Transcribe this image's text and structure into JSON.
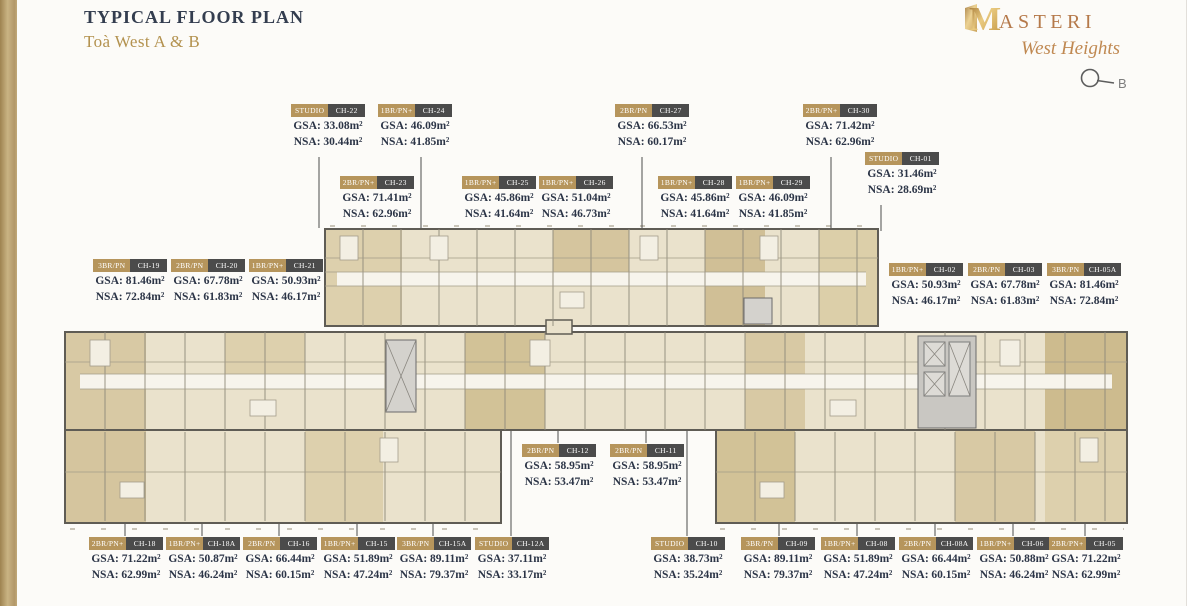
{
  "header": {
    "title": "TYPICAL FLOOR PLAN",
    "subtitle": "Toà West A & B",
    "brand": {
      "name_initial": "M",
      "name_rest": "ASTERI",
      "tagline": "West Heights"
    },
    "compass_label": "B"
  },
  "labels": {
    "gsa": "GSA:",
    "nsa": "NSA:",
    "m2": "m²"
  },
  "colors": {
    "tag_type_bg": "#b6955c",
    "tag_code_bg": "#4b4b4b",
    "title_navy": "#333d4f",
    "subtitle_gold": "#b3924f",
    "brand_copper": "#b5794a",
    "plan_tan": "#eae2cc"
  },
  "units": [
    {
      "type": "STUDIO",
      "code": "CH-22",
      "gsa": "33.08",
      "nsa": "30.44"
    },
    {
      "type": "1BR/PN+",
      "code": "CH-24",
      "gsa": "46.09",
      "nsa": "41.85"
    },
    {
      "type": "2BR/PN",
      "code": "CH-27",
      "gsa": "66.53",
      "nsa": "60.17"
    },
    {
      "type": "2BR/PN+",
      "code": "CH-30",
      "gsa": "71.42",
      "nsa": "62.96"
    },
    {
      "type": "STUDIO",
      "code": "CH-01",
      "gsa": "31.46",
      "nsa": "28.69"
    },
    {
      "type": "2BR/PN+",
      "code": "CH-23",
      "gsa": "71.41",
      "nsa": "62.96"
    },
    {
      "type": "1BR/PN+",
      "code": "CH-25",
      "gsa": "45.86",
      "nsa": "41.64"
    },
    {
      "type": "1BR/PN+",
      "code": "CH-26",
      "gsa": "51.04",
      "nsa": "46.73"
    },
    {
      "type": "1BR/PN+",
      "code": "CH-28",
      "gsa": "45.86",
      "nsa": "41.64"
    },
    {
      "type": "1BR/PN+",
      "code": "CH-29",
      "gsa": "46.09",
      "nsa": "41.85"
    },
    {
      "type": "3BR/PN",
      "code": "CH-19",
      "gsa": "81.46",
      "nsa": "72.84"
    },
    {
      "type": "2BR/PN",
      "code": "CH-20",
      "gsa": "67.78",
      "nsa": "61.83"
    },
    {
      "type": "1BR/PN+",
      "code": "CH-21",
      "gsa": "50.93",
      "nsa": "46.17"
    },
    {
      "type": "1BR/PN+",
      "code": "CH-02",
      "gsa": "50.93",
      "nsa": "46.17"
    },
    {
      "type": "2BR/PN",
      "code": "CH-03",
      "gsa": "67.78",
      "nsa": "61.83"
    },
    {
      "type": "3BR/PN",
      "code": "CH-05A",
      "gsa": "81.46",
      "nsa": "72.84"
    },
    {
      "type": "2BR/PN",
      "code": "CH-12",
      "gsa": "58.95",
      "nsa": "53.47"
    },
    {
      "type": "2BR/PN",
      "code": "CH-11",
      "gsa": "58.95",
      "nsa": "53.47"
    },
    {
      "type": "2BR/PN+",
      "code": "CH-18",
      "gsa": "71.22",
      "nsa": "62.99"
    },
    {
      "type": "1BR/PN+",
      "code": "CH-18A",
      "gsa": "50.87",
      "nsa": "46.24"
    },
    {
      "type": "2BR/PN",
      "code": "CH-16",
      "gsa": "66.44",
      "nsa": "60.15"
    },
    {
      "type": "1BR/PN+",
      "code": "CH-15",
      "gsa": "51.89",
      "nsa": "47.24"
    },
    {
      "type": "3BR/PN",
      "code": "CH-15A",
      "gsa": "89.11",
      "nsa": "79.37"
    },
    {
      "type": "STUDIO",
      "code": "CH-12A",
      "gsa": "37.11",
      "nsa": "33.17"
    },
    {
      "type": "STUDIO",
      "code": "CH-10",
      "gsa": "38.73",
      "nsa": "35.24"
    },
    {
      "type": "3BR/PN",
      "code": "CH-09",
      "gsa": "89.11",
      "nsa": "79.37"
    },
    {
      "type": "1BR/PN+",
      "code": "CH-08",
      "gsa": "51.89",
      "nsa": "47.24"
    },
    {
      "type": "2BR/PN",
      "code": "CH-08A",
      "gsa": "66.44",
      "nsa": "60.15"
    },
    {
      "type": "1BR/PN+",
      "code": "CH-06",
      "gsa": "50.88",
      "nsa": "46.24"
    },
    {
      "type": "2BR/PN+",
      "code": "CH-05",
      "gsa": "71.22",
      "nsa": "62.99"
    }
  ]
}
